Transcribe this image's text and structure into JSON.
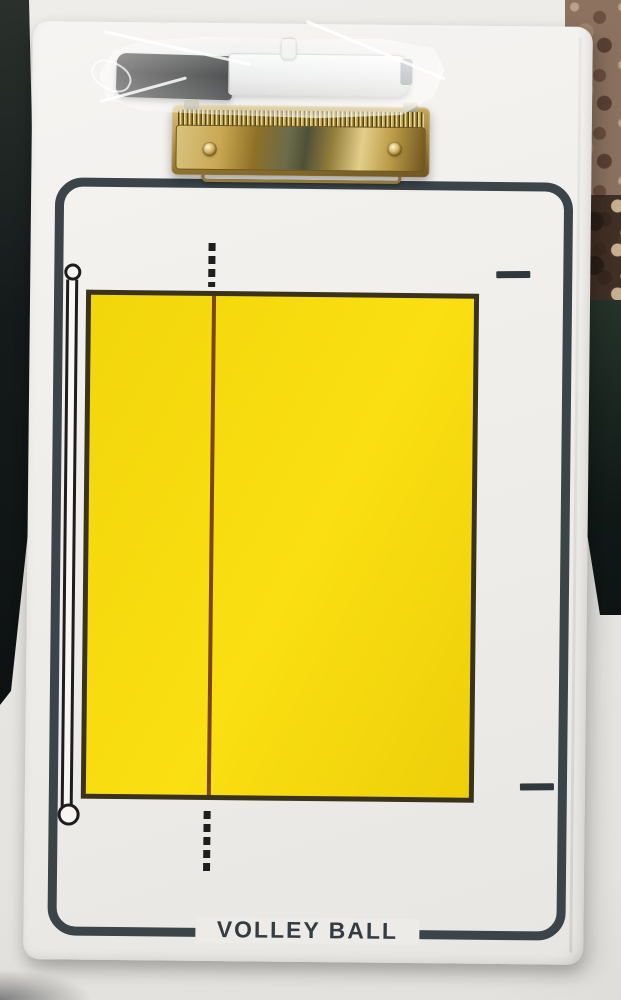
{
  "scene": {
    "description": "Product photo of a white dry-erase volleyball coaching clipboard lying on a pale surface. A low-profile gold metal clip is mounted at the top and a black-capped white dry-erase marker sealed in a clear plastic bag rests above it. The printed diagram shows a yellow volleyball court with a maroon center line, dashed center-line extensions, a net pole symbol on the left and attack-line tick marks on the right, all inside a dark rounded frame. Dark floor shows at the left edge, patterned brown carpet and dark green fabric at the right edge.",
    "board": {
      "title": "VOLLEY BALL",
      "court_label": "yellow volleyball court diagram"
    },
    "colors": {
      "board_white": "#f1efec",
      "frame_dark": "#3a4449",
      "court_yellow": "#f6d90d",
      "court_border": "#3b321a",
      "center_line_maroon": "#7a4512",
      "clip_gold": "#b8953f",
      "marker_cap_black": "#141414",
      "marker_body_white": "#f4f4f2",
      "carpet_brown": "#8d7260",
      "floor_dark": "#14191a",
      "fabric_green": "#1c2a22"
    }
  }
}
